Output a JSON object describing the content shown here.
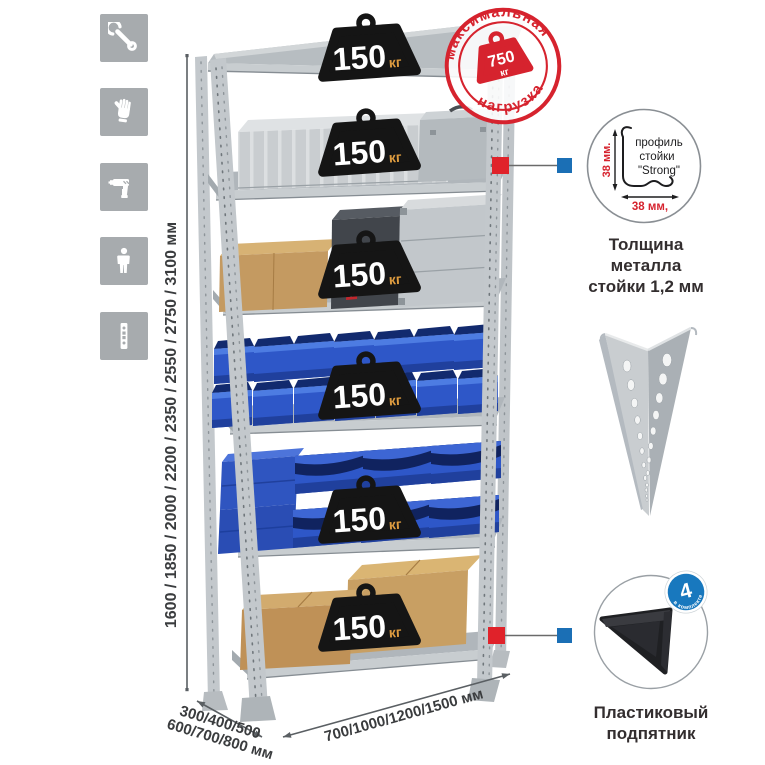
{
  "sidebar": {
    "tile_color": "#a7abae",
    "icons": [
      {
        "name": "wrench"
      },
      {
        "name": "work-gloves"
      },
      {
        "name": "drill"
      },
      {
        "name": "person"
      },
      {
        "name": "perforated-post"
      }
    ]
  },
  "rack": {
    "shelves": 6,
    "per_shelf_load": {
      "value": "150",
      "unit": "кг"
    }
  },
  "stamp": {
    "arc_top": "максимальная",
    "arc_bottom": "нагрузка",
    "value": "750",
    "unit": "кг"
  },
  "dimensions": {
    "height": "1600 / 1850 / 2000 / 2200 / 2350 / 2550 / 2750 / 3100 мм",
    "depth_line1": "300/400/500",
    "depth_line2": "600/700/800 мм",
    "width": "700/1000/1200/1500 мм"
  },
  "profile_detail": {
    "label_line1": "профиль",
    "label_line2": "стойки",
    "label_line3": "\"Strong\"",
    "dim_vertical": "38 мм.",
    "dim_horizontal": "38 мм,",
    "caption_line1": "Толщина металла",
    "caption_line2": "стойки 1,2 мм"
  },
  "foot_detail": {
    "badge_value": "4",
    "badge_arc_text": "в комплекте",
    "caption_line1": "Пластиковый",
    "caption_line2": "подпятник"
  },
  "colors": {
    "stamp_red": "#d6232e",
    "connector_red": "#e0222a",
    "connector_blue": "#1b6fb5",
    "badge_blue": "#1878be",
    "bin_blue": "#2e57c8",
    "metal_gray": "#b7bcc0",
    "tile_gray": "#a7abae",
    "weight_black": "#151515",
    "weight_unit_orange": "#dd9b3f",
    "cardboard": "#c49a61",
    "dim_text": "#3a3c3e"
  }
}
